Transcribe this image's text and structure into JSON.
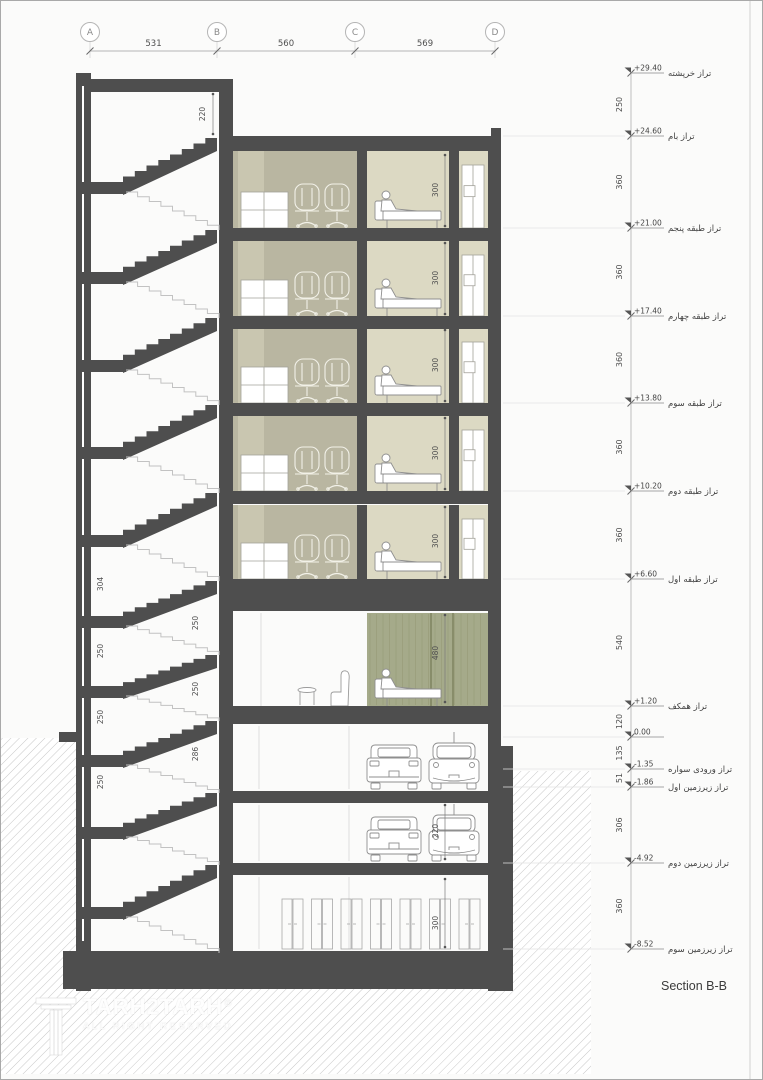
{
  "sheet": {
    "section_label": "Section B-B"
  },
  "logo": {
    "title": "TARH2TARH",
    "registered": "®",
    "subtitle": "ALL RIGHT RESERVED"
  },
  "colors": {
    "structure": "#4e4e4e",
    "olive_room": "#b9b6a1",
    "olive_band": "#c9c6b0",
    "beige_room": "#dcd9c3",
    "green_wall": "#a5aa8a",
    "green_stripe": "#959a76",
    "green_joint": "#7c815d",
    "hatch_line": "#c9c9c9",
    "outline": "#8f8f8f",
    "furniture_light": "#f2f1e8",
    "dim_text": "#4f4f4f",
    "grid_line": "#9e9e9e",
    "faint_line": "#d8d8d8"
  },
  "top_grid": {
    "bubbles": [
      {
        "label": "A",
        "x": 89
      },
      {
        "label": "B",
        "x": 216
      },
      {
        "label": "C",
        "x": 354
      },
      {
        "label": "D",
        "x": 494
      }
    ],
    "dimensions": [
      {
        "text": "531",
        "from": 89,
        "to": 216
      },
      {
        "text": "560",
        "from": 216,
        "to": 354
      },
      {
        "text": "569",
        "from": 354,
        "to": 494
      }
    ]
  },
  "levels": [
    {
      "y": 72,
      "value": "+29.40",
      "label_fa": "تراز خرپشته",
      "dim_below": "250"
    },
    {
      "y": 135,
      "value": "+24.60",
      "label_fa": "تراز بام",
      "dim_below": "360"
    },
    {
      "y": 227,
      "value": "+21.00",
      "label_fa": "تراز طبقه پنجم",
      "dim_below": "360"
    },
    {
      "y": 315,
      "value": "+17.40",
      "label_fa": "تراز طبقه چهارم",
      "dim_below": "360"
    },
    {
      "y": 402,
      "value": "+13.80",
      "label_fa": "تراز طبقه سوم",
      "dim_below": "360"
    },
    {
      "y": 490,
      "value": "+10.20",
      "label_fa": "تراز طبقه دوم",
      "dim_below": "360"
    },
    {
      "y": 578,
      "value": "+6.60",
      "label_fa": "تراز طبقه اول",
      "dim_below": "540"
    },
    {
      "y": 705,
      "value": "+1.20",
      "label_fa": "تراز همکف",
      "dim_below": "120"
    },
    {
      "y": 736,
      "value": "0.00",
      "label_fa": "",
      "dim_below": "135"
    },
    {
      "y": 768,
      "value": "-1.35",
      "label_fa": "تراز ورودی سواره",
      "dim_below": "51"
    },
    {
      "y": 786,
      "value": "-1.86",
      "label_fa": "تراز زیرزمین اول",
      "dim_below": "306"
    },
    {
      "y": 862,
      "value": "-4.92",
      "label_fa": "تراز زیرزمین دوم",
      "dim_below": "360"
    },
    {
      "y": 948,
      "value": "-8.52",
      "label_fa": "تراز زیرزمین سوم",
      "dim_below": ""
    }
  ],
  "interior_dimensions": [
    {
      "text": "220",
      "x": 204,
      "y": 113
    },
    {
      "text": "300",
      "x": 437,
      "y": 189
    },
    {
      "text": "300",
      "x": 437,
      "y": 277
    },
    {
      "text": "300",
      "x": 437,
      "y": 364
    },
    {
      "text": "300",
      "x": 437,
      "y": 452
    },
    {
      "text": "300",
      "x": 437,
      "y": 540
    },
    {
      "text": "480",
      "x": 437,
      "y": 652
    },
    {
      "text": "220",
      "x": 437,
      "y": 830
    },
    {
      "text": "300",
      "x": 437,
      "y": 922
    },
    {
      "text": "304",
      "x": 102,
      "y": 583
    },
    {
      "text": "250",
      "x": 102,
      "y": 650
    },
    {
      "text": "250",
      "x": 102,
      "y": 716
    },
    {
      "text": "250",
      "x": 102,
      "y": 781
    },
    {
      "text": "250",
      "x": 197,
      "y": 622
    },
    {
      "text": "250",
      "x": 197,
      "y": 688
    },
    {
      "text": "286",
      "x": 197,
      "y": 753
    }
  ]
}
